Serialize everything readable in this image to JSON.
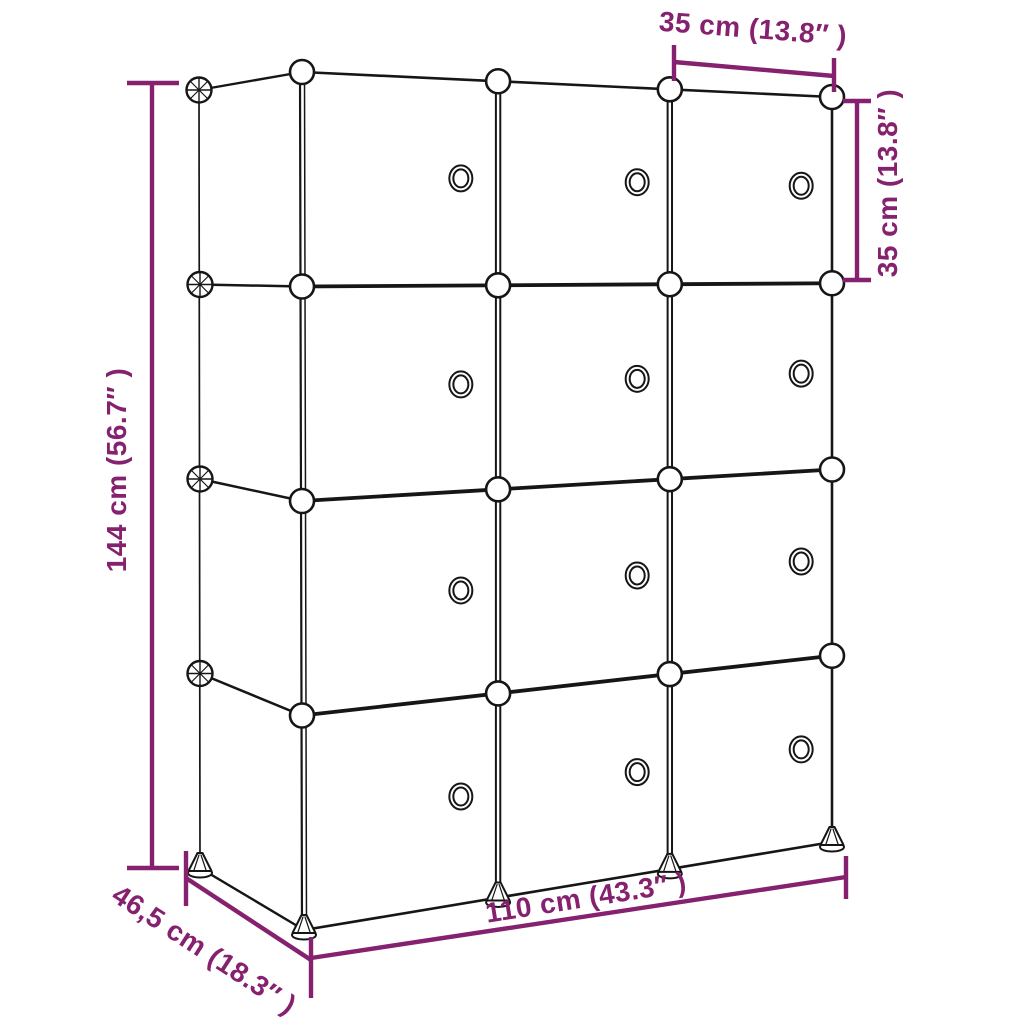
{
  "figure": {
    "type": "product-dimension-diagram",
    "subject": "cube-storage-organizer",
    "grid_columns": 3,
    "grid_rows": 4,
    "doors_with_knobs": 12
  },
  "colors": {
    "dimension_accent": "#85216E",
    "line_art": "#161616",
    "background": "#ffffff"
  },
  "labels": {
    "top_cube_width": "35 cm (13.8″ )",
    "right_cube_height": "35 cm (13.8″ )",
    "left_total_height": "144 cm (56.7″ )",
    "bottom_total_width": "110 cm (43.3″ )",
    "depth": "46,5 cm (18.3″ )"
  }
}
